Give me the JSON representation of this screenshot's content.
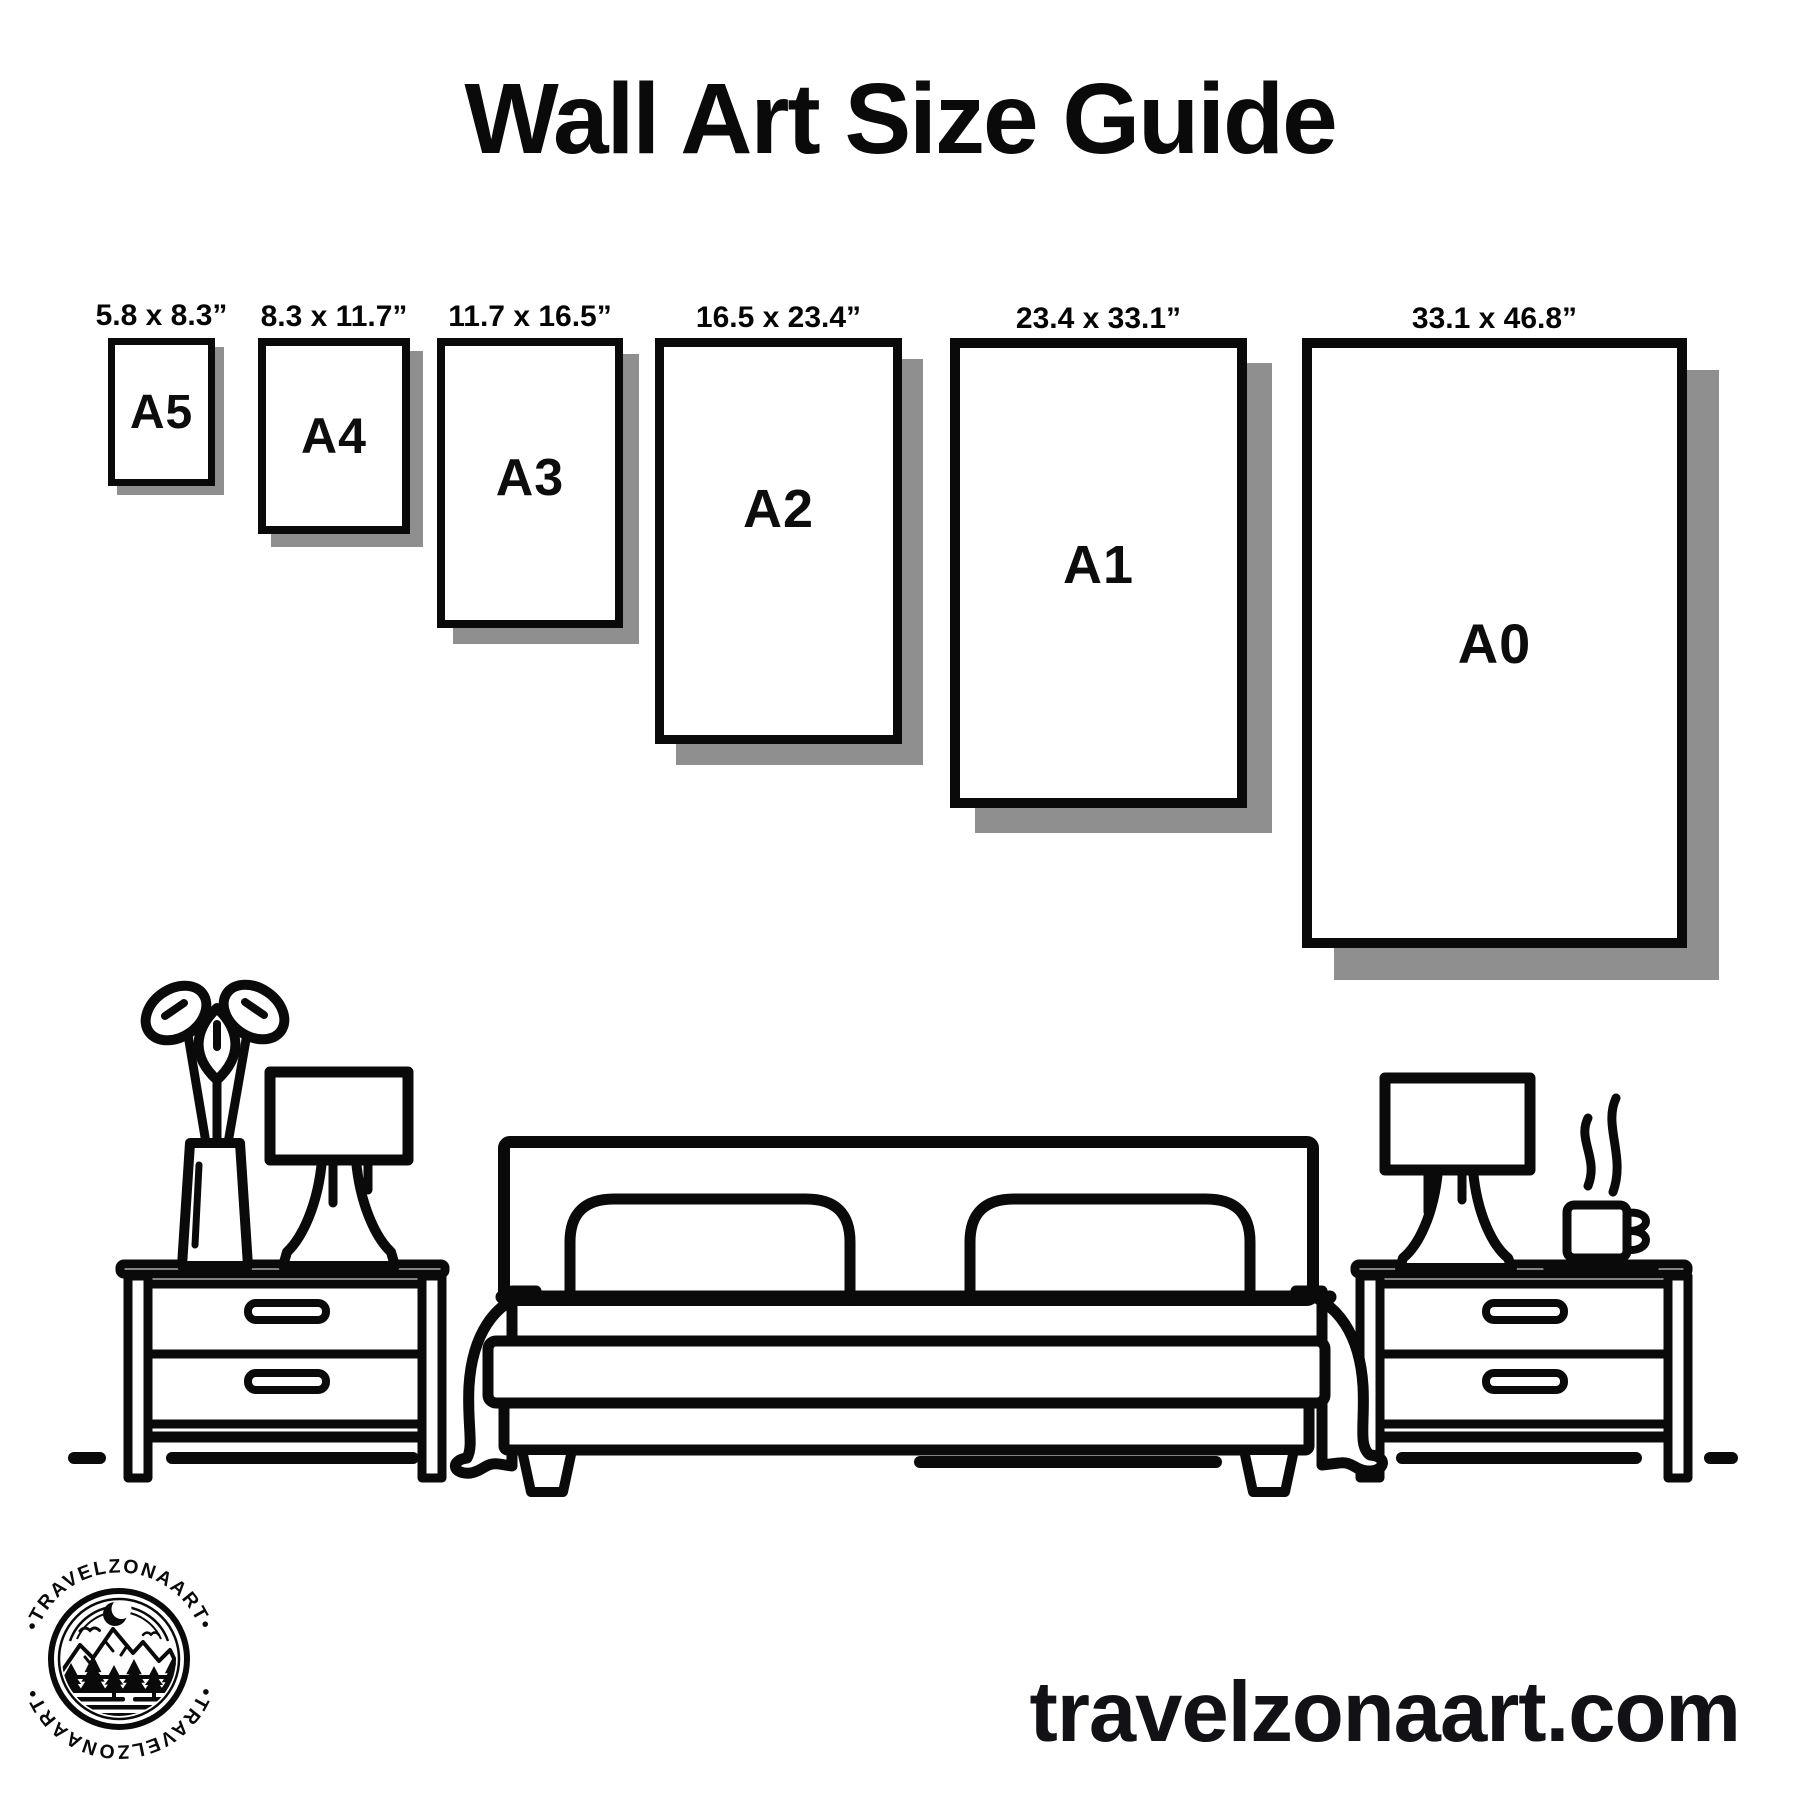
{
  "title": "Wall Art Size Guide",
  "frames": [
    {
      "name": "A5",
      "size_label": "5.8 x 8.3”"
    },
    {
      "name": "A4",
      "size_label": "8.3 x 11.7”"
    },
    {
      "name": "A3",
      "size_label": "11.7 x 16.5”"
    },
    {
      "name": "A2",
      "size_label": "16.5 x 23.4”"
    },
    {
      "name": "A1",
      "size_label": "23.4 x 33.1”"
    },
    {
      "name": "A0",
      "size_label": "33.1 x 46.8”"
    }
  ],
  "logo": {
    "brand_top": "•TRAVELZONAART•",
    "brand_bottom": "•TRAVELZONAART•"
  },
  "website": "travelzonaart.com",
  "icons": [
    "plant-vase-icon",
    "table-lamp-icon",
    "nightstand-icon",
    "double-bed-icon",
    "coffee-mug-icon",
    "mountain-moon-logo-icon"
  ],
  "colors": {
    "ink": "#0a0a0a",
    "frame_shadow": "#8f8f8f",
    "background": "#ffffff",
    "website_text": "#121216"
  }
}
